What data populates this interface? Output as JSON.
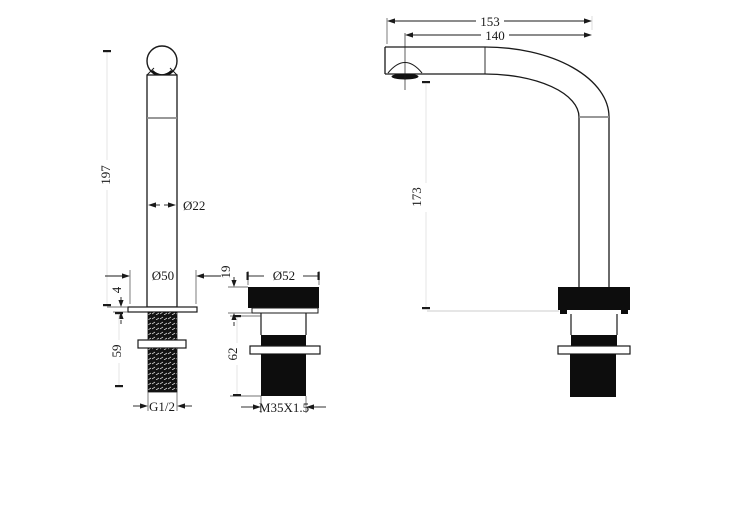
{
  "drawing": {
    "kind": "faucet-technical-dimension-drawing",
    "colors": {
      "line": "#1a1a1a",
      "background": "#ffffff",
      "joint_line": "#8a8a8a",
      "fill_black": "#0d0d0d"
    },
    "views": {
      "handle_front": {
        "height_label": "197",
        "column_diameter_label": "Ø22",
        "base_diameter_label": "Ø50",
        "flange_thickness_label": "4",
        "shank_length_label": "59",
        "thread_label": "G1/2"
      },
      "valve_body": {
        "top_height_label": "19",
        "top_diameter_label": "Ø52",
        "under_counter_length_label": "62",
        "thread_label": "M35X1.5"
      },
      "spout_side": {
        "overall_reach_label": "153",
        "aerator_reach_label": "140",
        "spout_height_label": "173"
      }
    }
  }
}
